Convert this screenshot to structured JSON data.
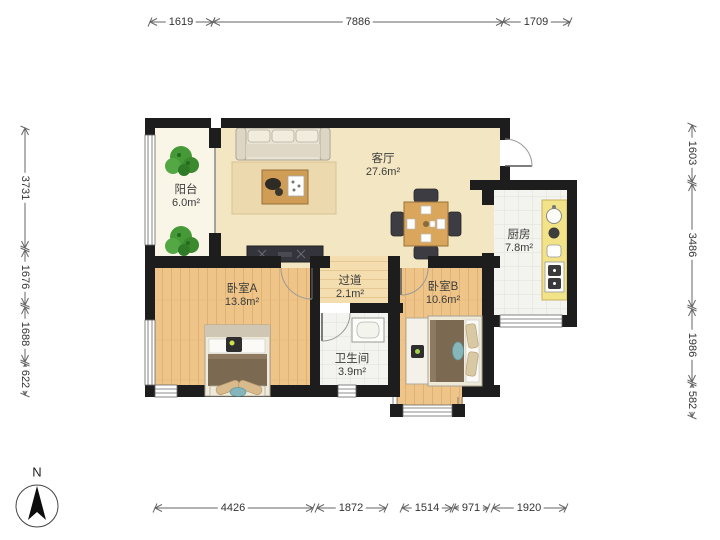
{
  "floor_plan": {
    "compass": {
      "label": "N"
    },
    "rooms": [
      {
        "id": "balcony",
        "name": "阳台",
        "area": "6.0m²"
      },
      {
        "id": "living",
        "name": "客厅",
        "area": "27.6m²"
      },
      {
        "id": "kitchen",
        "name": "厨房",
        "area": "7.8m²"
      },
      {
        "id": "bedroomA",
        "name": "卧室A",
        "area": "13.8m²"
      },
      {
        "id": "hallway",
        "name": "过道",
        "area": "2.1m²"
      },
      {
        "id": "bathroom",
        "name": "卫生间",
        "area": "3.9m²"
      },
      {
        "id": "bedroomB",
        "name": "卧室B",
        "area": "10.6m²"
      }
    ],
    "dimensions": {
      "top": [
        "1619",
        "7886",
        "1709"
      ],
      "bottom": [
        "4426",
        "1872",
        "1514",
        "971",
        "1920"
      ],
      "left": [
        "3731",
        "1676",
        "1688",
        "622"
      ],
      "right": [
        "1603",
        "3486",
        "1986",
        "582"
      ]
    },
    "colors": {
      "wall": "#1d1d1d",
      "living_floor": "#f3e6c2",
      "balcony_floor": "#f9f6e8",
      "wood_floor": "#eec489",
      "tile_floor": "#f3f3ef",
      "counter": "#f2e388",
      "blanket": "#7b6951",
      "plant": "#459a37",
      "dim_line": "#666666"
    }
  }
}
